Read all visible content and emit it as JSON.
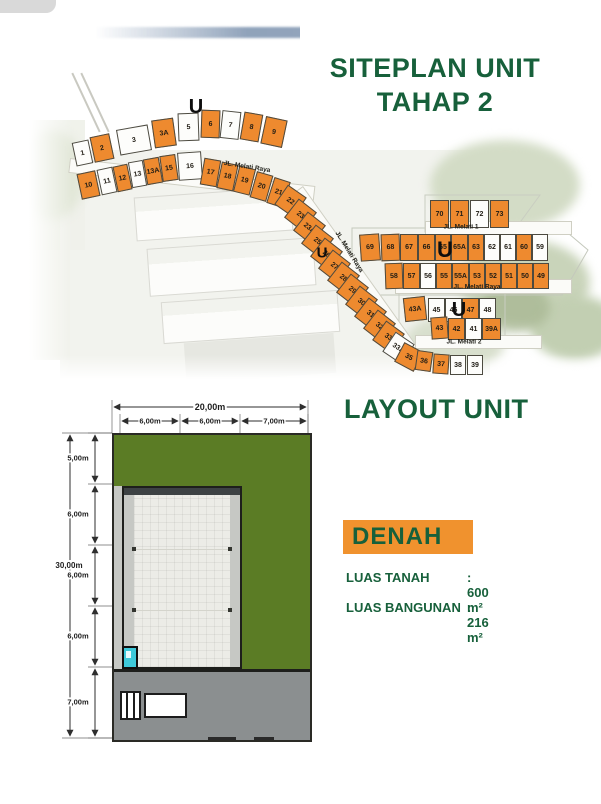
{
  "siteplan": {
    "title_line1": "SITEPLAN UNIT",
    "title_line2": "TAHAP 2",
    "north_label": "U",
    "north_markers": [
      {
        "x": 196,
        "y": 107,
        "s": 20
      },
      {
        "x": 322,
        "y": 253,
        "s": 15
      },
      {
        "x": 445,
        "y": 250,
        "s": 22
      },
      {
        "x": 459,
        "y": 310,
        "s": 20
      }
    ],
    "roads": [
      {
        "label": "JL. Melati Raya",
        "x": 247,
        "y": 167,
        "r": 9
      },
      {
        "label": "JL. Melati Raya",
        "x": 349,
        "y": 252,
        "r": 58
      },
      {
        "label": "JL. Melati 1",
        "x": 461,
        "y": 227,
        "r": 0
      },
      {
        "label": "JL. Melati Raya",
        "x": 477,
        "y": 287,
        "r": 0
      },
      {
        "label": "JL. Melati 2",
        "x": 464,
        "y": 342,
        "r": 0
      }
    ],
    "lots": [
      {
        "n": "1",
        "x": 74,
        "y": 141,
        "w": 17,
        "h": 24,
        "r": -12,
        "f": 0
      },
      {
        "n": "2",
        "x": 92,
        "y": 135,
        "w": 20,
        "h": 26,
        "r": -12,
        "f": 1
      },
      {
        "n": "3",
        "x": 118,
        "y": 127,
        "w": 32,
        "h": 26,
        "r": -10,
        "f": 0
      },
      {
        "n": "3A",
        "x": 153,
        "y": 119,
        "w": 22,
        "h": 28,
        "r": -8,
        "f": 1
      },
      {
        "n": "5",
        "x": 178,
        "y": 113,
        "w": 21,
        "h": 28,
        "r": -2,
        "f": 0
      },
      {
        "n": "6",
        "x": 201,
        "y": 110,
        "w": 19,
        "h": 28,
        "r": 2,
        "f": 1
      },
      {
        "n": "7",
        "x": 221,
        "y": 111,
        "w": 19,
        "h": 28,
        "r": 6,
        "f": 0
      },
      {
        "n": "8",
        "x": 242,
        "y": 113,
        "w": 19,
        "h": 28,
        "r": 10,
        "f": 1
      },
      {
        "n": "9",
        "x": 263,
        "y": 118,
        "w": 22,
        "h": 28,
        "r": 12,
        "f": 1
      },
      {
        "n": "10",
        "x": 79,
        "y": 172,
        "w": 19,
        "h": 26,
        "r": -12,
        "f": 1
      },
      {
        "n": "11",
        "x": 99,
        "y": 168,
        "w": 16,
        "h": 26,
        "r": -12,
        "f": 0
      },
      {
        "n": "12",
        "x": 115,
        "y": 165,
        "w": 15,
        "h": 26,
        "r": -12,
        "f": 1
      },
      {
        "n": "13",
        "x": 130,
        "y": 161,
        "w": 15,
        "h": 26,
        "r": -10,
        "f": 0
      },
      {
        "n": "13A",
        "x": 145,
        "y": 158,
        "w": 16,
        "h": 26,
        "r": -10,
        "f": 1
      },
      {
        "n": "15",
        "x": 161,
        "y": 155,
        "w": 16,
        "h": 26,
        "r": -8,
        "f": 1
      },
      {
        "n": "16",
        "x": 178,
        "y": 152,
        "w": 24,
        "h": 28,
        "r": -4,
        "f": 0
      },
      {
        "n": "17",
        "x": 202,
        "y": 159,
        "w": 17,
        "h": 27,
        "r": 10,
        "f": 1
      },
      {
        "n": "18",
        "x": 219,
        "y": 163,
        "w": 17,
        "h": 27,
        "r": 12,
        "f": 1
      },
      {
        "n": "19",
        "x": 236,
        "y": 167,
        "w": 17,
        "h": 27,
        "r": 14,
        "f": 1
      },
      {
        "n": "20",
        "x": 253,
        "y": 173,
        "w": 17,
        "h": 27,
        "r": 16,
        "f": 1
      },
      {
        "n": "21",
        "x": 270,
        "y": 179,
        "w": 17,
        "h": 27,
        "r": 18,
        "f": 1
      },
      {
        "n": "22",
        "x": 279,
        "y": 189,
        "w": 23,
        "h": 24,
        "r": 35,
        "f": 1
      },
      {
        "n": "23",
        "x": 289,
        "y": 203,
        "w": 23,
        "h": 24,
        "r": 38,
        "f": 1
      },
      {
        "n": "23A",
        "x": 298,
        "y": 216,
        "w": 23,
        "h": 24,
        "r": 38,
        "f": 1
      },
      {
        "n": "25",
        "x": 306,
        "y": 229,
        "w": 23,
        "h": 24,
        "r": 38,
        "f": 1
      },
      {
        "n": "26",
        "x": 315,
        "y": 242,
        "w": 23,
        "h": 24,
        "r": 38,
        "f": 1
      },
      {
        "n": "27",
        "x": 323,
        "y": 254,
        "w": 23,
        "h": 24,
        "r": 38,
        "f": 1
      },
      {
        "n": "28",
        "x": 332,
        "y": 266,
        "w": 23,
        "h": 24,
        "r": 38,
        "f": 1
      },
      {
        "n": "29",
        "x": 341,
        "y": 278,
        "w": 23,
        "h": 24,
        "r": 38,
        "f": 1
      },
      {
        "n": "30",
        "x": 350,
        "y": 290,
        "w": 23,
        "h": 24,
        "r": 38,
        "f": 1
      },
      {
        "n": "31",
        "x": 359,
        "y": 302,
        "w": 23,
        "h": 24,
        "r": 38,
        "f": 1
      },
      {
        "n": "32",
        "x": 368,
        "y": 314,
        "w": 23,
        "h": 24,
        "r": 38,
        "f": 1
      },
      {
        "n": "33",
        "x": 377,
        "y": 325,
        "w": 23,
        "h": 24,
        "r": 36,
        "f": 1
      },
      {
        "n": "33A",
        "x": 387,
        "y": 336,
        "w": 23,
        "h": 24,
        "r": 34,
        "f": 0
      },
      {
        "n": "35",
        "x": 398,
        "y": 346,
        "w": 22,
        "h": 22,
        "r": 28,
        "f": 1
      },
      {
        "n": "36",
        "x": 416,
        "y": 351,
        "w": 16,
        "h": 20,
        "r": 8,
        "f": 1
      },
      {
        "n": "37",
        "x": 433,
        "y": 354,
        "w": 16,
        "h": 20,
        "r": 4,
        "f": 1
      },
      {
        "n": "38",
        "x": 450,
        "y": 355,
        "w": 16,
        "h": 20,
        "r": 0,
        "f": 0
      },
      {
        "n": "39",
        "x": 467,
        "y": 355,
        "w": 16,
        "h": 20,
        "r": 0,
        "f": 0
      },
      {
        "n": "70",
        "x": 430,
        "y": 200,
        "w": 19,
        "h": 28,
        "r": 0,
        "f": 1
      },
      {
        "n": "71",
        "x": 450,
        "y": 200,
        "w": 19,
        "h": 28,
        "r": 0,
        "f": 1
      },
      {
        "n": "72",
        "x": 470,
        "y": 200,
        "w": 19,
        "h": 28,
        "r": 0,
        "f": 0
      },
      {
        "n": "73",
        "x": 490,
        "y": 200,
        "w": 19,
        "h": 28,
        "r": 0,
        "f": 1
      },
      {
        "n": "69",
        "x": 360,
        "y": 234,
        "w": 20,
        "h": 27,
        "r": -4,
        "f": 1
      },
      {
        "n": "68",
        "x": 381,
        "y": 234,
        "w": 19,
        "h": 27,
        "r": -2,
        "f": 1
      },
      {
        "n": "67",
        "x": 400,
        "y": 234,
        "w": 18,
        "h": 27,
        "r": 0,
        "f": 1
      },
      {
        "n": "66",
        "x": 418,
        "y": 234,
        "w": 17,
        "h": 27,
        "r": 0,
        "f": 1
      },
      {
        "n": "65",
        "x": 435,
        "y": 234,
        "w": 16,
        "h": 27,
        "r": 0,
        "f": 1
      },
      {
        "n": "65A",
        "x": 451,
        "y": 234,
        "w": 17,
        "h": 27,
        "r": 0,
        "f": 1
      },
      {
        "n": "63",
        "x": 468,
        "y": 234,
        "w": 16,
        "h": 27,
        "r": 0,
        "f": 1
      },
      {
        "n": "62",
        "x": 484,
        "y": 234,
        "w": 16,
        "h": 27,
        "r": 0,
        "f": 0
      },
      {
        "n": "61",
        "x": 500,
        "y": 234,
        "w": 16,
        "h": 27,
        "r": 0,
        "f": 0
      },
      {
        "n": "60",
        "x": 516,
        "y": 234,
        "w": 16,
        "h": 27,
        "r": 0,
        "f": 1
      },
      {
        "n": "59",
        "x": 532,
        "y": 234,
        "w": 16,
        "h": 27,
        "r": 0,
        "f": 0
      },
      {
        "n": "58",
        "x": 385,
        "y": 263,
        "w": 18,
        "h": 26,
        "r": -2,
        "f": 1
      },
      {
        "n": "57",
        "x": 403,
        "y": 263,
        "w": 17,
        "h": 26,
        "r": 0,
        "f": 1
      },
      {
        "n": "56",
        "x": 420,
        "y": 263,
        "w": 16,
        "h": 26,
        "r": 0,
        "f": 0
      },
      {
        "n": "55",
        "x": 436,
        "y": 263,
        "w": 16,
        "h": 26,
        "r": 0,
        "f": 1
      },
      {
        "n": "55A",
        "x": 452,
        "y": 263,
        "w": 17,
        "h": 26,
        "r": 0,
        "f": 1
      },
      {
        "n": "53",
        "x": 469,
        "y": 263,
        "w": 16,
        "h": 26,
        "r": 0,
        "f": 1
      },
      {
        "n": "52",
        "x": 485,
        "y": 263,
        "w": 16,
        "h": 26,
        "r": 0,
        "f": 1
      },
      {
        "n": "51",
        "x": 501,
        "y": 263,
        "w": 16,
        "h": 26,
        "r": 0,
        "f": 1
      },
      {
        "n": "50",
        "x": 517,
        "y": 263,
        "w": 16,
        "h": 26,
        "r": 0,
        "f": 1
      },
      {
        "n": "49",
        "x": 533,
        "y": 263,
        "w": 16,
        "h": 26,
        "r": 0,
        "f": 1
      },
      {
        "n": "43A",
        "x": 404,
        "y": 297,
        "w": 22,
        "h": 24,
        "r": -6,
        "f": 1
      },
      {
        "n": "45",
        "x": 428,
        "y": 298,
        "w": 17,
        "h": 24,
        "r": 0,
        "f": 0
      },
      {
        "n": "46",
        "x": 445,
        "y": 298,
        "w": 17,
        "h": 24,
        "r": 0,
        "f": 0
      },
      {
        "n": "47",
        "x": 462,
        "y": 298,
        "w": 17,
        "h": 24,
        "r": 0,
        "f": 1
      },
      {
        "n": "48",
        "x": 479,
        "y": 298,
        "w": 17,
        "h": 24,
        "r": 0,
        "f": 0
      },
      {
        "n": "43",
        "x": 431,
        "y": 317,
        "w": 17,
        "h": 22,
        "r": -4,
        "f": 1
      },
      {
        "n": "42",
        "x": 448,
        "y": 318,
        "w": 17,
        "h": 22,
        "r": 0,
        "f": 1
      },
      {
        "n": "41",
        "x": 465,
        "y": 318,
        "w": 17,
        "h": 22,
        "r": 0,
        "f": 0
      },
      {
        "n": "39A",
        "x": 482,
        "y": 318,
        "w": 19,
        "h": 22,
        "r": 0,
        "f": 1
      }
    ]
  },
  "layout": {
    "title": "LAYOUT UNIT",
    "badge": "DENAH",
    "info": [
      {
        "label": "LUAS TANAH",
        "value": ": 600 m²"
      },
      {
        "label": "LUAS BANGUNAN",
        "value": ": 216 m²"
      }
    ],
    "dimensions": {
      "top_total": "20,00m",
      "top_segments": [
        "6,00m",
        "6,00m",
        "7,00m"
      ],
      "left_total": "30,00m",
      "left_segments": [
        "5,00m",
        "6,00m",
        "6,00m",
        "6,00m",
        "7,00m"
      ]
    }
  },
  "colors": {
    "accent_green": "#17603B",
    "lot_orange": "#EE8A2F",
    "plan_green": "#5B7C25",
    "driveway_grey": "#8B8F90",
    "toilet_cyan": "#3EC9DA"
  }
}
